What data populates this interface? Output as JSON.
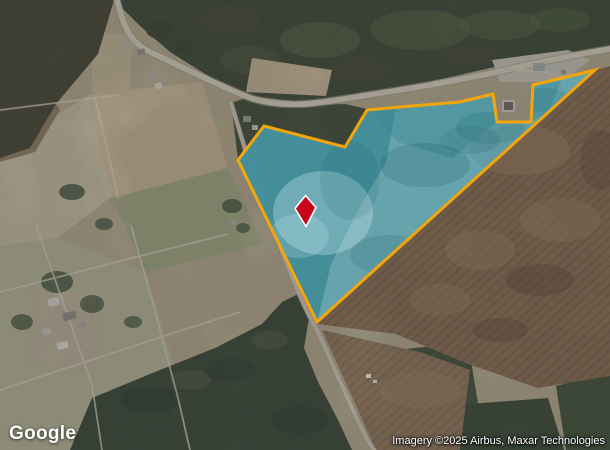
{
  "map": {
    "provider_logo": "Google",
    "attribution": "Imagery ©2025 Airbus, Maxar Technologies",
    "parcel": {
      "points": "264,126 345,147 367,110 400,107 460,102 493,94 497,122 531,122 533,85 595,70 317,322 238,160",
      "fill_color": "#47C1DF",
      "fill_opacity": "0.54",
      "border_color": "#F3A60B",
      "border_width": "3"
    },
    "marker": {
      "points": "305.5,195.5 316,207.5 306,226.5 295,208.5",
      "fill_color": "#C7051B",
      "outline_color": "#FFFFFF"
    }
  }
}
